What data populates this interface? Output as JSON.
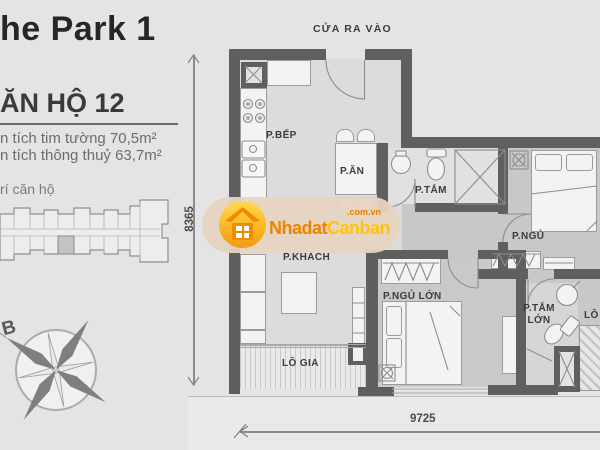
{
  "header": {
    "project_title": "he Park 1"
  },
  "unit": {
    "title": "ĂN HỘ 12",
    "area_gross": "n tích tim tường 70,5m²",
    "area_net": "n tích thông thuỷ 63,7m²",
    "position_caption": "rí căn hộ"
  },
  "compass": {
    "north_label": "B"
  },
  "plan": {
    "entrance_label": "CỬA RA VÀO",
    "rooms": {
      "kitchen": "P.BẾP",
      "dining": "P.ĂN",
      "bathroom": "P.TẮM",
      "bedroom": "P.NGỦ",
      "living": "P.KHÁCH",
      "master_bedroom": "P.NGỦ LỚN",
      "master_bathroom": "P.TẮM LỚN",
      "loggia": "LÔ GIA",
      "loggia_right": "LÔ"
    },
    "dimensions": {
      "vertical": "8365",
      "horizontal": "9725"
    }
  },
  "watermark": {
    "brand_primary": "Nhadat",
    "brand_secondary": "Canban",
    "brand_suffix": ".com.vn",
    "colors": {
      "primary": "#ef8200",
      "secondary": "#ffc30f",
      "pill": "#e5d4c0"
    }
  },
  "colors": {
    "background": "#e4e4e4",
    "wall": "#5f5f5f",
    "floor_light": "#dcdcdc",
    "floor_dark": "#c8c8c8"
  }
}
